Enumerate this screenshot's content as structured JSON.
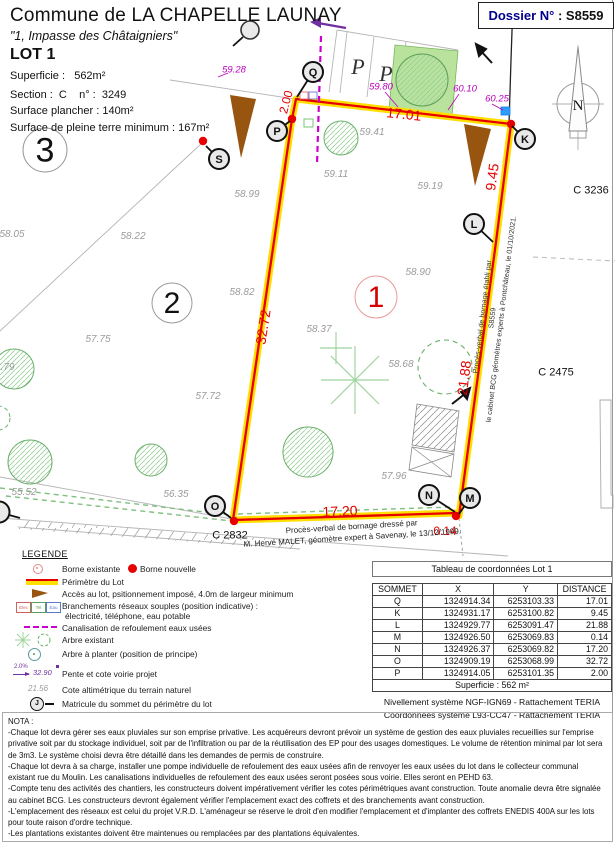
{
  "colors": {
    "red": "#e60000",
    "yellow": "#ffdf00",
    "magenta": "#bb00bb",
    "purple": "#7030a0",
    "brown": "#97550f",
    "green": "#5a9a5a",
    "navy": "#00008c",
    "blue_box": "#2e9bff"
  },
  "header": {
    "commune": "Commune de LA CHAPELLE LAUNAY",
    "address": "\"1, Impasse des Châtaigniers\"",
    "lot": "LOT 1",
    "superficie": "Superficie :   562m²",
    "section": "Section :  C    n° :  3249",
    "surface_plancher": "Surface plancher : 140m²",
    "pleine_terre": "Surface de pleine terre minimum : 167m²",
    "dossier_prefix": "Dossier N°",
    "dossier_value": " : S8559"
  },
  "plan": {
    "compass_letter": "N",
    "parking_letters": [
      {
        "text": "P",
        "x": 358,
        "y": 67
      },
      {
        "text": "P",
        "x": 386,
        "y": 74
      }
    ],
    "lot_circles": [
      {
        "label": "3",
        "x": 45,
        "y": 150,
        "r": 22,
        "fs": 34,
        "stroke": "#9a9a9a",
        "color": "#111"
      },
      {
        "label": "2",
        "x": 172,
        "y": 303,
        "r": 20,
        "fs": 30,
        "stroke": "#9a9a9a",
        "color": "#111"
      },
      {
        "label": "1",
        "x": 376,
        "y": 297,
        "r": 21,
        "fs": 30,
        "stroke": "#e79a9a",
        "color": "#d40000"
      }
    ],
    "vertices": [
      {
        "id": "Q",
        "x": 313,
        "y": 72,
        "lx": 297,
        "ly": 97
      },
      {
        "id": "P",
        "x": 277,
        "y": 131,
        "lx": 290,
        "ly": 121
      },
      {
        "id": "S",
        "x": 219,
        "y": 159,
        "lx": 206,
        "ly": 146
      },
      {
        "id": "K",
        "x": 525,
        "y": 139,
        "lx": 512,
        "ly": 126
      },
      {
        "id": "L",
        "x": 474,
        "y": 224,
        "lx": 493,
        "ly": 242
      },
      {
        "id": "M",
        "x": 470,
        "y": 498,
        "lx": 459,
        "ly": 514
      },
      {
        "id": "N",
        "x": 429,
        "y": 495,
        "lx": 455,
        "ly": 512
      },
      {
        "id": "O",
        "x": 215,
        "y": 506,
        "lx": 231,
        "ly": 518
      }
    ],
    "bornes": [
      [
        292,
        119
      ],
      [
        511,
        124
      ],
      [
        456,
        516
      ],
      [
        234,
        521
      ],
      [
        203,
        141
      ]
    ],
    "dims": [
      {
        "text": "17.01",
        "x": 404,
        "y": 114,
        "rot": 6,
        "size": 14
      },
      {
        "text": "9.45",
        "x": 492,
        "y": 177,
        "rot": -82,
        "size": 14
      },
      {
        "text": "21.88",
        "x": 464,
        "y": 378,
        "rot": -83,
        "size": 14
      },
      {
        "text": "0.14",
        "x": 445,
        "y": 531,
        "rot": 0,
        "size": 12
      },
      {
        "text": "17.20",
        "x": 340,
        "y": 511,
        "rot": -2,
        "size": 14
      },
      {
        "text": "32.72",
        "x": 263,
        "y": 327,
        "rot": -81,
        "size": 14
      },
      {
        "text": "2.00",
        "x": 286,
        "y": 102,
        "rot": -75,
        "size": 12
      }
    ],
    "spots": [
      {
        "text": "59.28",
        "x": 234,
        "y": 70
      },
      {
        "text": "59.80",
        "x": 381,
        "y": 87
      },
      {
        "text": "60.10",
        "x": 465,
        "y": 89
      },
      {
        "text": "60.25",
        "x": 497,
        "y": 99
      }
    ],
    "elevations": [
      {
        "text": "59.41",
        "x": 372,
        "y": 133
      },
      {
        "text": "59.11",
        "x": 336,
        "y": 175
      },
      {
        "text": "59.19",
        "x": 430,
        "y": 187
      },
      {
        "text": "58.99",
        "x": 247,
        "y": 195
      },
      {
        "text": "58.05",
        "x": 12,
        "y": 235
      },
      {
        "text": "58.22",
        "x": 133,
        "y": 237
      },
      {
        "text": "58.82",
        "x": 242,
        "y": 293
      },
      {
        "text": "58.90",
        "x": 418,
        "y": 273
      },
      {
        "text": "58.37",
        "x": 319,
        "y": 330
      },
      {
        "text": "58.68",
        "x": 401,
        "y": 365
      },
      {
        "text": "57.75",
        "x": 98,
        "y": 340
      },
      {
        "text": "57.72",
        "x": 208,
        "y": 397
      },
      {
        "text": "56.79",
        "x": 2,
        "y": 368
      },
      {
        "text": "57.96",
        "x": 394,
        "y": 477
      },
      {
        "text": "56.35",
        "x": 176,
        "y": 495
      },
      {
        "text": "55.52",
        "x": 24,
        "y": 493
      }
    ],
    "parcels": [
      {
        "text": "C 3236",
        "x": 591,
        "y": 191
      },
      {
        "text": "C 2475",
        "x": 556,
        "y": 373
      },
      {
        "text": "C 2832",
        "x": 230,
        "y": 536
      }
    ],
    "note_right": {
      "lines": [
        "Procès-verbal de bornage établi par",
        "S8559",
        "le cabinet BCG géomètres experts à Pontchâteau, le 01/10/2021."
      ]
    },
    "note_bottom": {
      "lines": [
        "Procès-verbal de bornage dressé par",
        "M. Hervé MALET, géomètre expert à Savenay, le 13/12/1999."
      ]
    }
  },
  "legend": {
    "title": "LEGENDE",
    "borne_existante": "Borne existante",
    "borne_nouvelle": "Borne nouvelle",
    "perimetre": "Périmètre du Lot",
    "acces": "Accès au lot, psitionnement imposé, 4.0m de largeur minimum",
    "branchements1": "Branchements réseaux souples (position indicative) :",
    "branchements2": "électricité, téléphone, eau potable",
    "box_labels": [
      "Elec",
      "Tel",
      "Eau"
    ],
    "canalisation": "Canalisation de refoulement eaux usées",
    "arbre_existant": "Arbre existant",
    "arbre_planter": "Arbre à planter (position de principe)",
    "pente": "Pente et cote voirie projet",
    "pente_pct": "2.0%",
    "pente_val": "32.90",
    "cote": "Cote altimétrique du terrain naturel",
    "cote_val": "21.56",
    "matricule": "Matricule du sommet du périmètre du lot",
    "matricule_letter": "J"
  },
  "table": {
    "title": "Tableau de coordonnées Lot 1",
    "headers": [
      "SOMMET",
      "X",
      "Y",
      "DISTANCE"
    ],
    "rows": [
      [
        "Q",
        "1324914.34",
        "6253103.33",
        "17.01"
      ],
      [
        "K",
        "1324931.17",
        "6253100.82",
        "9.45"
      ],
      [
        "L",
        "1324929.77",
        "6253091.47",
        "21.88"
      ],
      [
        "M",
        "1324926.50",
        "6253069.83",
        "0.14"
      ],
      [
        "N",
        "1324926.37",
        "6253069.82",
        "17.20"
      ],
      [
        "O",
        "1324909.19",
        "6253068.99",
        "32.72"
      ],
      [
        "P",
        "1324914.05",
        "6253101.35",
        "2.00"
      ]
    ],
    "footer": "Superficie : 562 m²",
    "note1": "Nivellement système NGF-IGN69 - Rattachement TERIA",
    "note2": "Coordonnées système L93-CC47  - Rattachement TERIA"
  },
  "nota": {
    "title": "NOTA :",
    "paragraphs": [
      "-Chaque lot devra gérer ses eaux pluviales sur son emprise privative. Les acquéreurs devront prévoir un système de gestion des eaux pluviales recueillies sur l'emprise privative soit par du stockage individuel, soit par de l'infiltration ou par de la réutilisation des EP pour des usages domestiques. Le volume de rétention minimal par lot sera de 3m3. Le système choisi devra être détaillé dans les demandes de permis de construire.",
      "-Chaque lot devra à sa charge, installer une pompe individuelle de refoulement des eaux usées afin de renvoyer les eaux usées du lot dans le collecteur communal existant rue du Moulin. Les canalisations individuelles de refoulement des eaux usées seront posées sous voirie. Elles seront en PEHD 63.",
      "-Compte tenu des activités des chantiers, les constructeurs doivent impérativement vérifier les cotes périmétriques avant construction. Toute anomalie devra être signalée au cabinet BCG. Les constructeurs devront également vérifier l'emplacement exact des coffrets et des branchements avant construction.",
      "-L'emplacement des réseaux est celui du projet V.R.D. L'aménageur se réserve le droit d'en modifier l'emplacement et d'implanter des coffrets ENEDIS 400A sur les lots pour toute raison d'ordre technique.",
      "-Les plantations existantes doivent être maintenues ou remplacées par des plantations équivalentes."
    ]
  }
}
